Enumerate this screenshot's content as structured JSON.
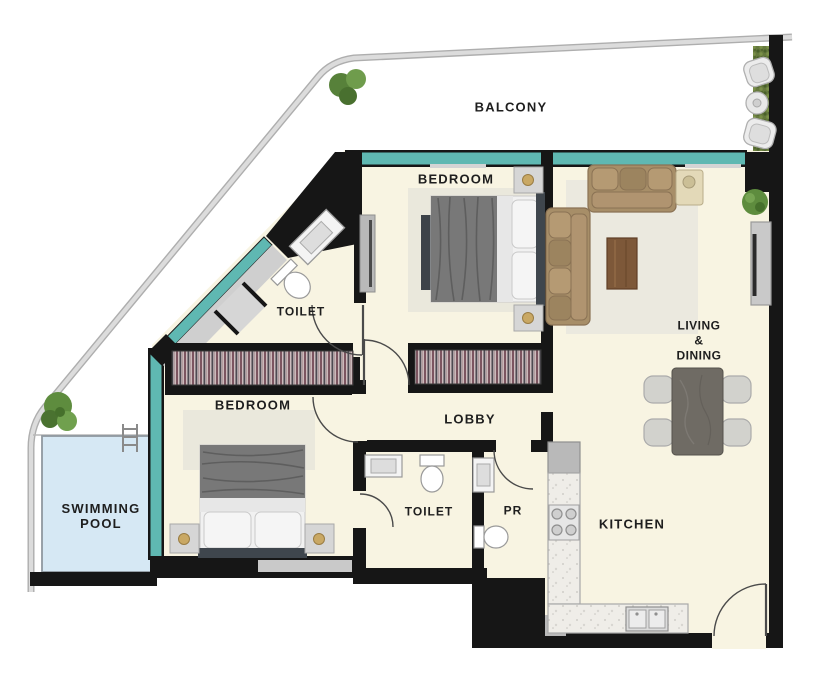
{
  "title": "Apartment floor plan with swimming pool",
  "labels": {
    "balcony": "BALCONY",
    "bedroom_top": "BEDROOM",
    "toilet_top": "TOILET",
    "bedroom_bottom": "BEDROOM",
    "lobby": "LOBBY",
    "swimming_pool": "SWIMMING\nPOOL",
    "toilet_bottom": "TOILET",
    "powder_room": "PR",
    "kitchen": "KITCHEN",
    "living_dining": "LIVING\n&\nDINING"
  },
  "colors": {
    "wall": "#161616",
    "floor": "#f8f4e2",
    "window_teal": "#5fb8b2",
    "pool_water": "#d6e8f4",
    "pool_border": "#8f98a0",
    "road": "#c2c2c2",
    "rug": "#eae8dc",
    "sofa_tan": "#a78e68",
    "coffee_table": "#7d5839",
    "dining_table": "#6f6b64",
    "chair_gray": "#d2d2cd",
    "hedge_green": "#65793d",
    "tree_green": "#5e8c3e",
    "counter": "#efede8",
    "fixture_gray": "#d6d6d6",
    "lamp_gold": "#c9a864"
  }
}
